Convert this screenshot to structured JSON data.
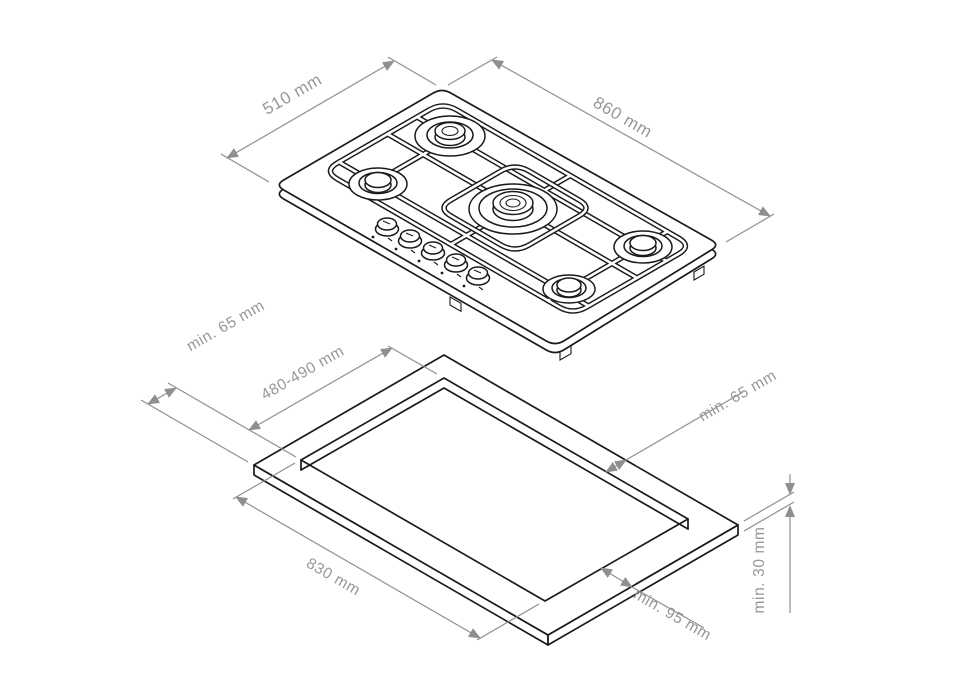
{
  "diagram": {
    "type": "gas-hob-installation-drawing",
    "colors": {
      "line": "#1a1a1a",
      "dimension": "#8f8f8f",
      "background": "#ffffff"
    },
    "hob": {
      "depth_label": "510 mm",
      "width_label": "860 mm",
      "burner_count": 5,
      "knob_count": 5
    },
    "worktop_cutout": {
      "side_clearance_label": "min. 65 mm",
      "cutout_depth_label": "480-490 mm",
      "rear_clearance_label": "min. 65 mm",
      "cutout_width_label": "830 mm",
      "front_clearance_label": "min. 95 mm",
      "worktop_thickness_label": "min. 30 mm"
    }
  }
}
